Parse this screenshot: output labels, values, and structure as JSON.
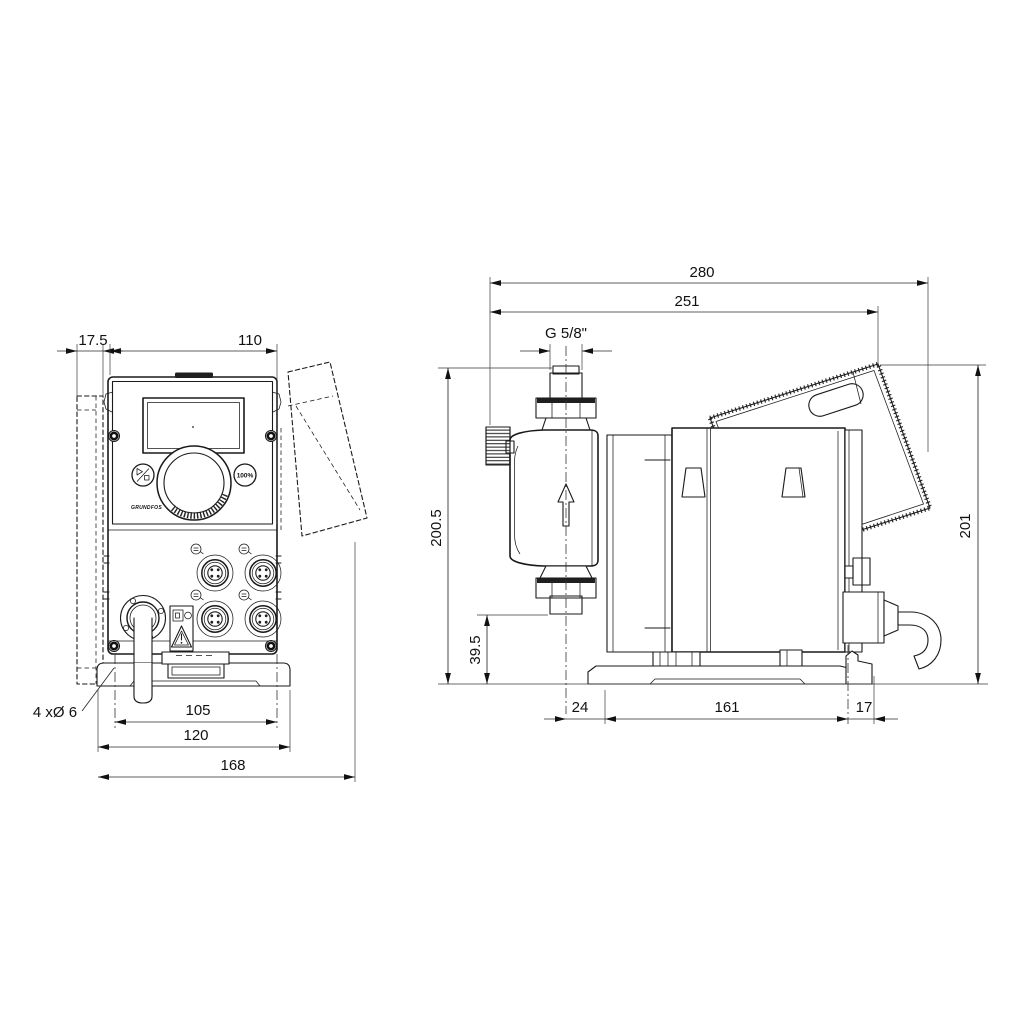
{
  "style": {
    "background": "#ffffff",
    "line_color": "#1a1a1a"
  },
  "front_view": {
    "dims": {
      "head_protrusion": "17.5",
      "housing_width": "110",
      "mounting_hole_spacing": "105",
      "mounting_plate_width": "120",
      "overall_width": "168"
    },
    "mounting_holes_note": "4 xØ 6",
    "control_panel": {
      "percent_button_label": "100%",
      "brand_logo": "GRUNDFOS"
    },
    "icons": {
      "run_stop_button": "play-stop-icon",
      "click_wheel": "rotary-knob",
      "warning_label": "warning-triangle-icon",
      "cable_gland": "cable-gland",
      "m12_connectors": "m12-connector-socket"
    }
  },
  "side_view": {
    "dims": {
      "overall_depth": "280",
      "depth_to_cover": "251",
      "connection_thread": "G 5/8\"",
      "pump_head_height": "200.5",
      "valve_to_base_height": "39.5",
      "head_center_to_plate_front": "24",
      "mounting_plate_length": "161",
      "plate_rear_overhang": "17",
      "overall_height": "201"
    },
    "icons": {
      "flow_direction": "up-arrow-icon",
      "power_cable": "cable"
    }
  }
}
